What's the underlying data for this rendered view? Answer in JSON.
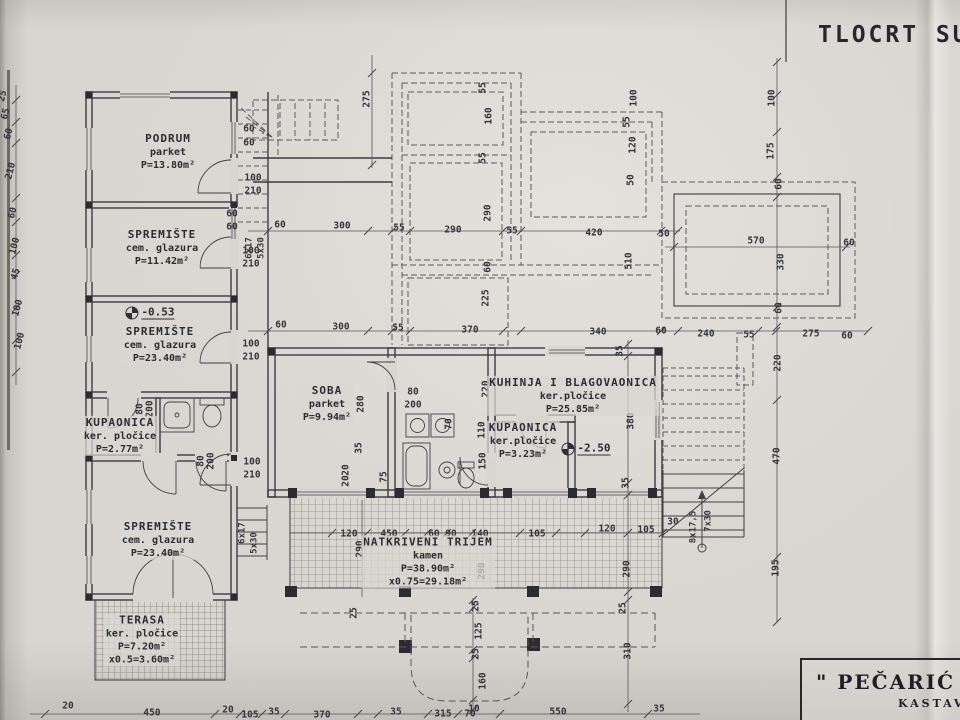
{
  "meta": {
    "title": "TLOCRT SUTER"
  },
  "title_block": {
    "line1": "\" PEČARIĆ G",
    "line2": "KASTAV"
  },
  "rooms": [
    {
      "name": "PODRUM",
      "finish": "parket",
      "area": "P=13.80m²",
      "x": 168,
      "y": 152
    },
    {
      "name": "SPREMIŠTE",
      "finish": "cem. glazura",
      "area": "P=11.42m²",
      "x": 162,
      "y": 248
    },
    {
      "name": "SPREMIŠTE",
      "finish": "cem. glazura",
      "area": "P=23.40m²",
      "x": 160,
      "y": 345
    },
    {
      "name": "KUPAONICA",
      "finish": "ker. pločice",
      "area": "P=2.77m²",
      "x": 120,
      "y": 436
    },
    {
      "name": "SPREMIŠTE",
      "finish": "cem. glazura",
      "area": "P=23.40m²",
      "x": 158,
      "y": 540
    },
    {
      "name": "TERASA",
      "finish": "ker. pločice",
      "area": "P=7.20m²",
      "extra": "x0.5=3.60m²",
      "x": 142,
      "y": 640
    },
    {
      "name": "SOBA",
      "finish": "parket",
      "area": "P=9.94m²",
      "x": 327,
      "y": 404
    },
    {
      "name": "KUHINJA I BLAGOVAONICA",
      "finish": "ker.pločice",
      "area": "P=25.85m²",
      "x": 573,
      "y": 396
    },
    {
      "name": "KUPAONICA",
      "finish": "ker.pločice",
      "area": "P=3.23m²",
      "x": 523,
      "y": 441
    },
    {
      "name": "NATKRIVENI TRIJEM",
      "finish": "kamen",
      "area": "P=38.90m²",
      "extra": "x0.75=29.18m²",
      "x": 428,
      "y": 562
    }
  ],
  "levels": [
    {
      "value": "-0.53",
      "x": 150,
      "y": 313
    },
    {
      "value": "-2.50",
      "x": 586,
      "y": 449
    }
  ],
  "annotations": [
    {
      "t": "6x17",
      "x": 250,
      "y": 248,
      "r": -90
    },
    {
      "t": "5x30",
      "x": 262,
      "y": 248,
      "r": -90
    },
    {
      "t": "6x17",
      "x": 243,
      "y": 533,
      "r": -90
    },
    {
      "t": "5x30",
      "x": 255,
      "y": 543,
      "r": -90
    },
    {
      "t": "8x17,5",
      "x": 694,
      "y": 527,
      "r": -90
    },
    {
      "t": "7x30",
      "x": 709,
      "y": 521,
      "r": -90
    }
  ],
  "dims": [
    {
      "t": "275",
      "x": 367,
      "y": 99,
      "r": -90
    },
    {
      "t": "55",
      "x": 483,
      "y": 88,
      "r": -90
    },
    {
      "t": "160",
      "x": 489,
      "y": 116,
      "r": -90
    },
    {
      "t": "55",
      "x": 483,
      "y": 158,
      "r": -90
    },
    {
      "t": "290",
      "x": 488,
      "y": 213,
      "r": -90
    },
    {
      "t": "60",
      "x": 488,
      "y": 267,
      "r": -90
    },
    {
      "t": "225",
      "x": 486,
      "y": 298,
      "r": -90
    },
    {
      "t": "55",
      "x": 627,
      "y": 122,
      "r": -90
    },
    {
      "t": "100",
      "x": 634,
      "y": 98,
      "r": -90
    },
    {
      "t": "120",
      "x": 633,
      "y": 145,
      "r": -90
    },
    {
      "t": "50",
      "x": 631,
      "y": 180,
      "r": -90
    },
    {
      "t": "510",
      "x": 629,
      "y": 261,
      "r": -90
    },
    {
      "t": "100",
      "x": 772,
      "y": 98,
      "r": -90
    },
    {
      "t": "175",
      "x": 771,
      "y": 151,
      "r": -90
    },
    {
      "t": "60",
      "x": 779,
      "y": 184,
      "r": -90
    },
    {
      "t": "330",
      "x": 781,
      "y": 262,
      "r": -90
    },
    {
      "t": "60",
      "x": 779,
      "y": 308,
      "r": -90
    },
    {
      "t": "220",
      "x": 778,
      "y": 363,
      "r": -90
    },
    {
      "t": "470",
      "x": 777,
      "y": 456,
      "r": -90
    },
    {
      "t": "195",
      "x": 776,
      "y": 568,
      "r": -90
    },
    {
      "t": "60",
      "x": 280,
      "y": 225
    },
    {
      "t": "300",
      "x": 342,
      "y": 226
    },
    {
      "t": "55",
      "x": 399,
      "y": 228
    },
    {
      "t": "290",
      "x": 453,
      "y": 230
    },
    {
      "t": "55",
      "x": 512,
      "y": 231
    },
    {
      "t": "420",
      "x": 594,
      "y": 233
    },
    {
      "t": "50",
      "x": 664,
      "y": 234
    },
    {
      "t": "570",
      "x": 756,
      "y": 241
    },
    {
      "t": "60",
      "x": 849,
      "y": 243
    },
    {
      "t": "60",
      "x": 281,
      "y": 325
    },
    {
      "t": "300",
      "x": 341,
      "y": 327
    },
    {
      "t": "55",
      "x": 398,
      "y": 328
    },
    {
      "t": "370",
      "x": 470,
      "y": 330
    },
    {
      "t": "340",
      "x": 598,
      "y": 332
    },
    {
      "t": "60",
      "x": 661,
      "y": 331
    },
    {
      "t": "240",
      "x": 706,
      "y": 334
    },
    {
      "t": "55",
      "x": 749,
      "y": 335
    },
    {
      "t": "275",
      "x": 811,
      "y": 334
    },
    {
      "t": "60",
      "x": 847,
      "y": 336
    },
    {
      "t": "60",
      "x": 249,
      "y": 129
    },
    {
      "t": "60",
      "x": 249,
      "y": 143
    },
    {
      "t": "100",
      "x": 253,
      "y": 178
    },
    {
      "t": "210",
      "x": 253,
      "y": 191
    },
    {
      "t": "60",
      "x": 232,
      "y": 214
    },
    {
      "t": "60",
      "x": 232,
      "y": 227
    },
    {
      "t": "100",
      "x": 251,
      "y": 251
    },
    {
      "t": "210",
      "x": 251,
      "y": 264
    },
    {
      "t": "100",
      "x": 251,
      "y": 344
    },
    {
      "t": "210",
      "x": 251,
      "y": 357
    },
    {
      "t": "100",
      "x": 252,
      "y": 462
    },
    {
      "t": "210",
      "x": 252,
      "y": 475
    },
    {
      "t": "80",
      "x": 140,
      "y": 409,
      "r": -90
    },
    {
      "t": "200",
      "x": 150,
      "y": 409,
      "r": -90
    },
    {
      "t": "80",
      "x": 201,
      "y": 461,
      "r": -90
    },
    {
      "t": "200",
      "x": 211,
      "y": 461,
      "r": -90
    },
    {
      "t": "25",
      "x": 3,
      "y": 96,
      "r": -75
    },
    {
      "t": "65",
      "x": 6,
      "y": 114,
      "r": -75
    },
    {
      "t": "60",
      "x": 9,
      "y": 134,
      "r": -75
    },
    {
      "t": "210",
      "x": 11,
      "y": 171,
      "r": -75
    },
    {
      "t": "60",
      "x": 13,
      "y": 213,
      "r": -75
    },
    {
      "t": "100",
      "x": 15,
      "y": 246,
      "r": -75
    },
    {
      "t": "45",
      "x": 16,
      "y": 274,
      "r": -75
    },
    {
      "t": "100",
      "x": 18,
      "y": 308,
      "r": -75
    },
    {
      "t": "100",
      "x": 20,
      "y": 341,
      "r": -75
    },
    {
      "t": "280",
      "x": 361,
      "y": 404,
      "r": -90
    },
    {
      "t": "35",
      "x": 359,
      "y": 448,
      "r": -90
    },
    {
      "t": "80",
      "x": 413,
      "y": 392
    },
    {
      "t": "200",
      "x": 413,
      "y": 405
    },
    {
      "t": "70",
      "x": 449,
      "y": 424,
      "r": -90
    },
    {
      "t": "20",
      "x": 346,
      "y": 470,
      "r": -90
    },
    {
      "t": "20",
      "x": 346,
      "y": 481,
      "r": -90
    },
    {
      "t": "75",
      "x": 384,
      "y": 477,
      "r": -90
    },
    {
      "t": "220",
      "x": 486,
      "y": 389,
      "r": -90
    },
    {
      "t": "110",
      "x": 482,
      "y": 430,
      "r": -90
    },
    {
      "t": "150",
      "x": 483,
      "y": 461,
      "r": -90
    },
    {
      "t": "380",
      "x": 631,
      "y": 421,
      "r": -90
    },
    {
      "t": "120",
      "x": 349,
      "y": 534
    },
    {
      "t": "450",
      "x": 389,
      "y": 534
    },
    {
      "t": "60",
      "x": 434,
      "y": 534
    },
    {
      "t": "90",
      "x": 451,
      "y": 534
    },
    {
      "t": "140",
      "x": 480,
      "y": 534
    },
    {
      "t": "105",
      "x": 537,
      "y": 534
    },
    {
      "t": "290",
      "x": 360,
      "y": 549,
      "r": -90
    },
    {
      "t": "290",
      "x": 482,
      "y": 571,
      "r": -90
    },
    {
      "t": "25",
      "x": 354,
      "y": 613,
      "r": -90
    },
    {
      "t": "25",
      "x": 476,
      "y": 606,
      "r": -90
    },
    {
      "t": "125",
      "x": 479,
      "y": 631,
      "r": -90
    },
    {
      "t": "25",
      "x": 476,
      "y": 654,
      "r": -90
    },
    {
      "t": "160",
      "x": 483,
      "y": 681,
      "r": -90
    },
    {
      "t": "10",
      "x": 474,
      "y": 709
    },
    {
      "t": "315",
      "x": 443,
      "y": 714
    },
    {
      "t": "550",
      "x": 558,
      "y": 712
    },
    {
      "t": "35",
      "x": 396,
      "y": 712
    },
    {
      "t": "35",
      "x": 274,
      "y": 712
    },
    {
      "t": "20",
      "x": 68,
      "y": 706
    },
    {
      "t": "450",
      "x": 152,
      "y": 713
    },
    {
      "t": "20",
      "x": 228,
      "y": 710
    },
    {
      "t": "105",
      "x": 250,
      "y": 715
    },
    {
      "t": "370",
      "x": 322,
      "y": 715
    },
    {
      "t": "70",
      "x": 470,
      "y": 714
    },
    {
      "t": "35",
      "x": 620,
      "y": 351,
      "r": -90
    },
    {
      "t": "35",
      "x": 626,
      "y": 483,
      "r": -90
    },
    {
      "t": "120",
      "x": 607,
      "y": 529
    },
    {
      "t": "105",
      "x": 646,
      "y": 530
    },
    {
      "t": "30",
      "x": 673,
      "y": 522
    },
    {
      "t": "290",
      "x": 627,
      "y": 569,
      "r": -90
    },
    {
      "t": "25",
      "x": 623,
      "y": 608,
      "r": -90
    },
    {
      "t": "310",
      "x": 628,
      "y": 651,
      "r": -90
    },
    {
      "t": "35",
      "x": 659,
      "y": 709
    }
  ]
}
